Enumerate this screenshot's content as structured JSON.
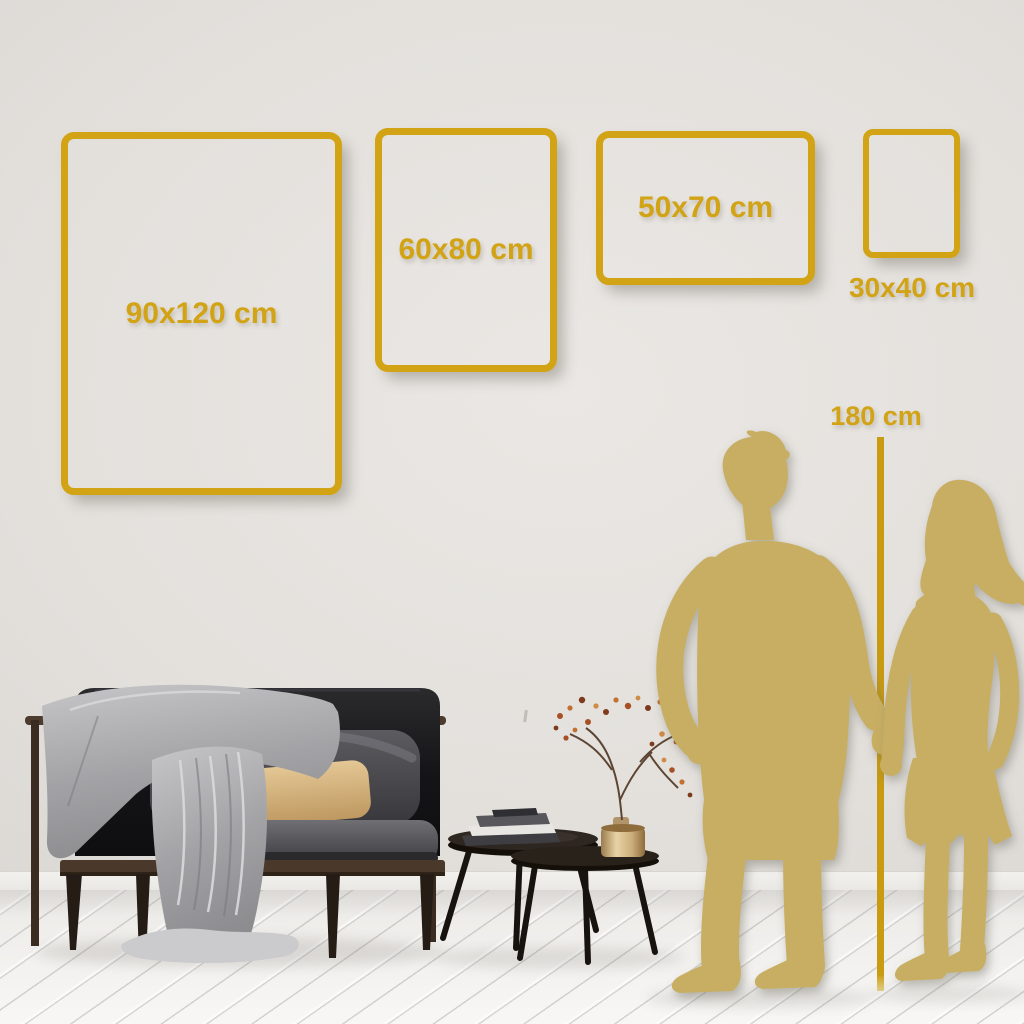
{
  "guide": {
    "frames": [
      {
        "label": "90x120 cm",
        "orientation": "portrait"
      },
      {
        "label": "60x80 cm",
        "orientation": "portrait"
      },
      {
        "label": "50x70 cm",
        "orientation": "landscape"
      },
      {
        "label": "30x40 cm",
        "orientation": "portrait"
      }
    ],
    "height_reference": {
      "label": "180 cm"
    }
  },
  "colors": {
    "frame_gold": "#D2A315",
    "label_gold": "#D2A315",
    "ruler_gold": "#C89B10",
    "silhouette_gold": "#C7AE62"
  },
  "scene": {
    "elements": [
      "dark-velvet-sofa",
      "gray-throw-blanket",
      "back-cushion",
      "tan-pillow",
      "nesting-coffee-tables",
      "stacked-books",
      "gold-vase-with-dried-branch",
      "white-plank-floor",
      "man-silhouette",
      "woman-silhouette",
      "height-ruler-line"
    ]
  }
}
